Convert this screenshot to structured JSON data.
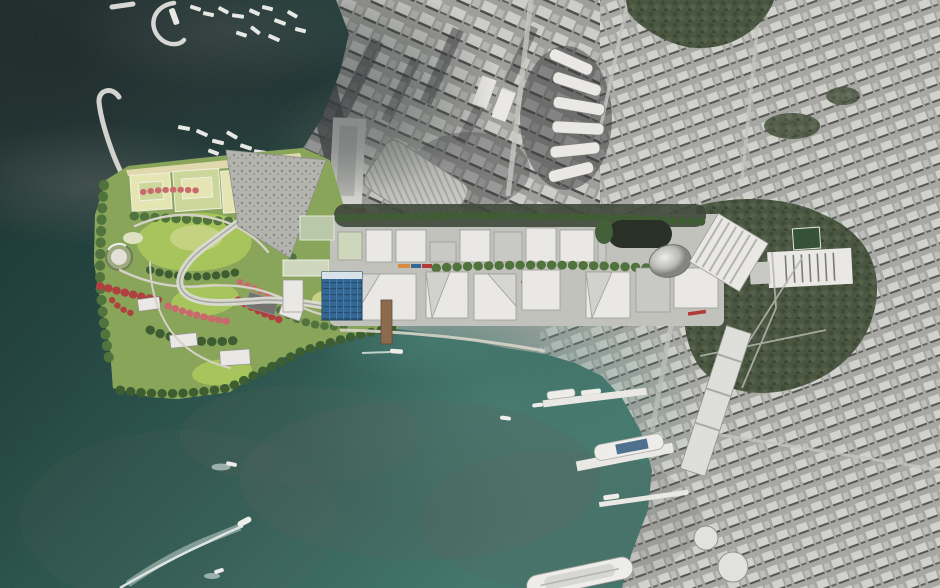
{
  "scene": {
    "name": "Aerial photomontage masterplan — waterfront cultural district and harbour",
    "type": "aerial-map-render",
    "palette": {
      "water_deep": "#132926",
      "water_dark": "#1e403b",
      "water_mid": "#2c5a52",
      "water_light": "#3f746a",
      "water_pale": "#4c8377",
      "sediment": "#5c6058",
      "haze_dark": "#20272a",
      "haze_gray": "#4f5754",
      "city_base": "#a2a29e",
      "city_block_light": "#cfcfcb",
      "city_block_mid": "#8f8f8b",
      "city_shadow": "#3c3c3a",
      "city_road": "#c9c9c5",
      "foliage_city": "#45523c",
      "foliage_dark": "#39462f",
      "park_base": "#86a455",
      "lawn_bright": "#a6c558",
      "lawn_pale": "#c4d37e",
      "field_pale": "#e6e7b2",
      "field_green": "#cdd89a",
      "sand_tan": "#e2d9ad",
      "tree_green": "#4c7038",
      "tree_dark": "#38592b",
      "flower_red": "#b03a3a",
      "flower_pink": "#c9666a",
      "path_light": "#d6d2c6",
      "building_white": "#eceae6",
      "building_gray": "#c9c9c5",
      "building_shadow": "#8e8e8a",
      "glass_blue": "#2f6391",
      "glass_grid": "#1f4668",
      "pier_brown": "#8a6848",
      "dome_silver": "#c9c9c7",
      "dark_capsule": "#232a20",
      "ship_white": "#f0efec",
      "wake_white": "#e3ece6",
      "accent_red": "#b23430",
      "accent_orange": "#d98a3a",
      "accent_purple": "#7a5fa0"
    },
    "features": {
      "water_area": "dark teal harbour water, lower left half",
      "typhoon_shelter": "marina with moored boat clusters, top left",
      "breakwater_count": 3,
      "headland_park": "rendered green park with lawns, sports fields, flowering red trees, circular pavilion and curved viaduct",
      "district_blocks": "two rows of white faceted development blocks with tree strips",
      "dome_pavilion": "rounded silver dome building",
      "dark_station_band": "dark rounded station structure north of blocks",
      "waterfront_pier": "timber pier reaching into the harbour",
      "ferry_piers_count": 3,
      "berthed_ships_count": 3,
      "cruise_ship": "large white ship at bottom edge",
      "moving_boats_count": 4,
      "city_fabric": "grayscale satellite city blocks, top and right",
      "crescent_tower_count": 6,
      "skyscraper_shadow": "long diagonal tower shadow, top centre",
      "urban_park": "large tree-covered city park with white pool complex, right side"
    }
  }
}
